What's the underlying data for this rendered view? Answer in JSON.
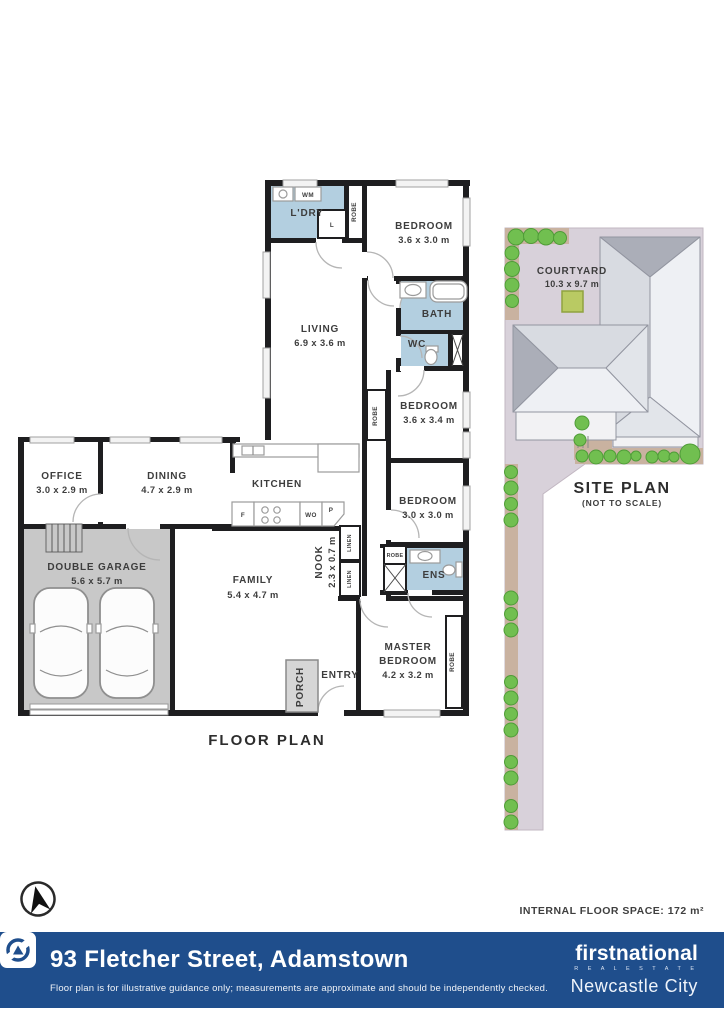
{
  "colors": {
    "wall": "#1e1e20",
    "wet_area": "#b3cfe0",
    "garage_fill": "#c8c8c8",
    "site_parcel": "#d8d1da",
    "site_garden": "#c9b2a0",
    "tree": "#71bf50",
    "roof": "#d8dbe1",
    "footer_bar": "#1f4e8c",
    "courtyard_marker": "#b9ca63"
  },
  "fp": {
    "title": "FLOOR PLAN",
    "ldry": "L'DRY",
    "wm": "WM",
    "l": "L",
    "robe": "ROBE",
    "linen": "LINEN",
    "bed1_name": "BEDROOM",
    "bed1_dims": "3.6 x 3.0 m",
    "living_name": "LIVING",
    "living_dims": "6.9 x 3.6 m",
    "bath": "BATH",
    "wc": "WC",
    "bed2_name": "BEDROOM",
    "bed2_dims": "3.6 x 3.4 m",
    "bed3_name": "BEDROOM",
    "bed3_dims": "3.0 x 3.0 m",
    "office_name": "OFFICE",
    "office_dims": "3.0 x 2.9 m",
    "dining_name": "DINING",
    "dining_dims": "4.7 x 2.9 m",
    "kitchen": "KITCHEN",
    "f": "F",
    "wo": "WO",
    "p": "P",
    "nook_name": "NOOK",
    "nook_dims": "2.3 x 0.7 m",
    "family_name": "FAMILY",
    "family_dims": "5.4 x 4.7 m",
    "garage_name": "DOUBLE GARAGE",
    "garage_dims": "5.6 x 5.7 m",
    "ens": "ENS",
    "master_l1": "MASTER",
    "master_l2": "BEDROOM",
    "master_dims": "4.2 x 3.2 m",
    "entry": "ENTRY",
    "porch": "PORCH"
  },
  "sp": {
    "title": "SITE PLAN",
    "subtitle": "(NOT TO SCALE)",
    "courtyard": "COURTYARD",
    "courtyard_dims": "10.3 x 9.7 m"
  },
  "meta": {
    "floor_space": "INTERNAL FLOOR SPACE: 172 m²",
    "compass_icon": "north-arrow"
  },
  "footer": {
    "address": "93 Fletcher Street, Adamstown",
    "disclaimer": "Floor plan is for illustrative guidance only; measurements are approximate and should be independently checked.",
    "brand": "firstnational",
    "brand_sub": "R E A L   E S T A T E",
    "office": "Newcastle City"
  }
}
